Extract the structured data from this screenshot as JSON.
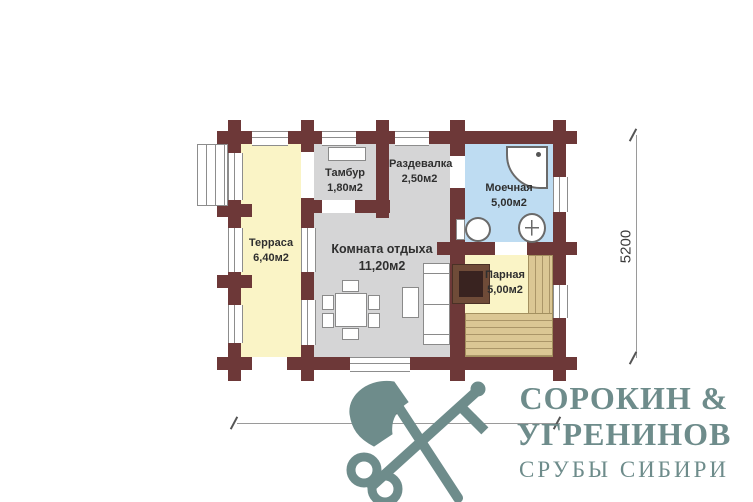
{
  "plan": {
    "rooms": [
      {
        "name": "Терраса",
        "area": "6,40м2"
      },
      {
        "name": "Тамбур",
        "area": "1,80м2"
      },
      {
        "name": "Раздевалка",
        "area": "2,50м2"
      },
      {
        "name": "Моечная",
        "area": "5,00м2"
      },
      {
        "name": "Комната отдыха",
        "area": "11,20м2"
      },
      {
        "name": "Парная",
        "area": "5,00м2"
      }
    ],
    "dimensions": {
      "width_mm": "7600",
      "height_mm": "5200"
    },
    "colors": {
      "wall": "#6d3838",
      "terrace_fill": "#faf4c6",
      "steam_fill": "#faf4c6",
      "washing_fill": "#bedcf2",
      "dry_room_fill": "#d5d5d6",
      "bench": "#dbc794",
      "logo_accent": "#6e8c8b"
    }
  },
  "logo": {
    "title_line1": "СОРОКИН &",
    "title_line2": "УГРЕНИНОВ",
    "subtitle": "СРУБЫ СИБИРИ"
  }
}
